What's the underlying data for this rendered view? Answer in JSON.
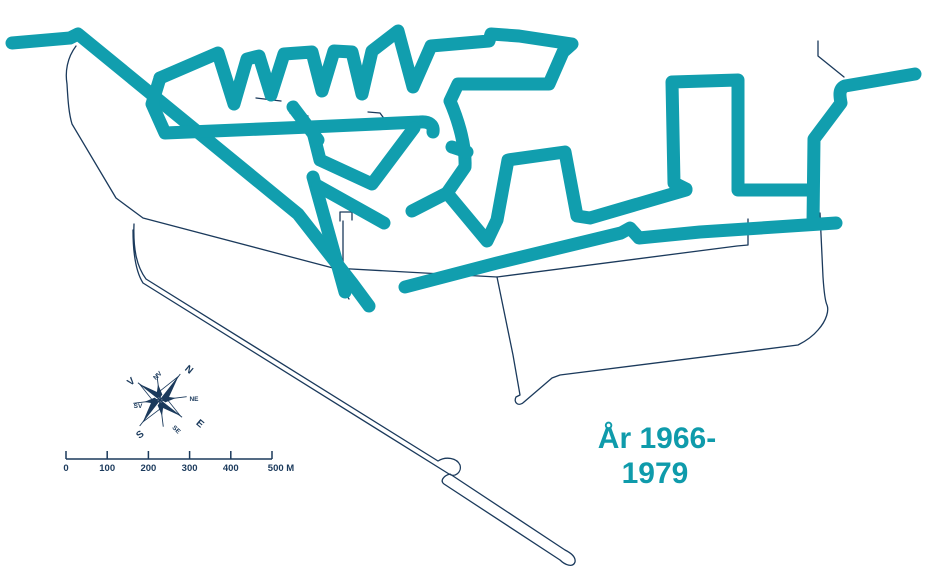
{
  "map": {
    "name": "harbor-network-map",
    "title_line1": "År 1966-",
    "title_line2": "1979",
    "colors": {
      "network": "#119EAE",
      "outline": "#1B3A5C",
      "title": "#0F9BAB"
    },
    "scale_bar": {
      "labels": [
        "0",
        "100",
        "200",
        "300",
        "400",
        "500 M"
      ]
    },
    "compass": {
      "n": "N",
      "ne": "NE",
      "e": "E",
      "se": "SE",
      "s": "S",
      "sv": "SV",
      "v": "V",
      "nv": "NV"
    }
  }
}
